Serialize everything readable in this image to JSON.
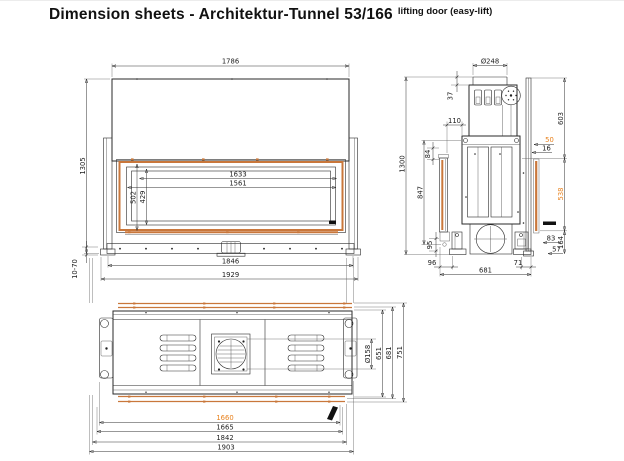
{
  "title": {
    "main": "Dimension sheets - Architektur-Tunnel 53/166",
    "suffix": "lifting door (easy-lift)"
  },
  "colors": {
    "accent_orange": "#e8821e",
    "frame_orange": "#c9773b",
    "line": "#2a2a2a"
  },
  "front_view": {
    "dims": {
      "top_width": "1786",
      "height": "1305",
      "opening_width": "1633",
      "glass_width": "1561",
      "opening_height": "502",
      "glass_height": "429",
      "body_width": "1846",
      "overall_width": "1929",
      "foot_adjust_range": "10-70"
    }
  },
  "side_view": {
    "dims": {
      "flue_diameter": "Ø248",
      "flue_offset": "37",
      "top_guide": "110",
      "upper_section_height": "603",
      "lift_gap": "50",
      "frame_gap": "16",
      "door_glass_height": "538",
      "upper_glass_edge": "84",
      "door_lift_height": "847",
      "lower_glass_edge": "95",
      "base_step_1": "83",
      "base_step_2": "57",
      "base_height": "164",
      "front_clearance": "96",
      "rear_clearance": "71",
      "depth": "681",
      "overall_height": "1300"
    }
  },
  "plan_view": {
    "dims": {
      "duct_diameter": "Ø158",
      "inner_depth": "651",
      "body_depth": "681",
      "overall_depth": "751",
      "glass_width": "1660",
      "opening_width": "1665",
      "body_width": "1842",
      "overall_width": "1903"
    }
  }
}
